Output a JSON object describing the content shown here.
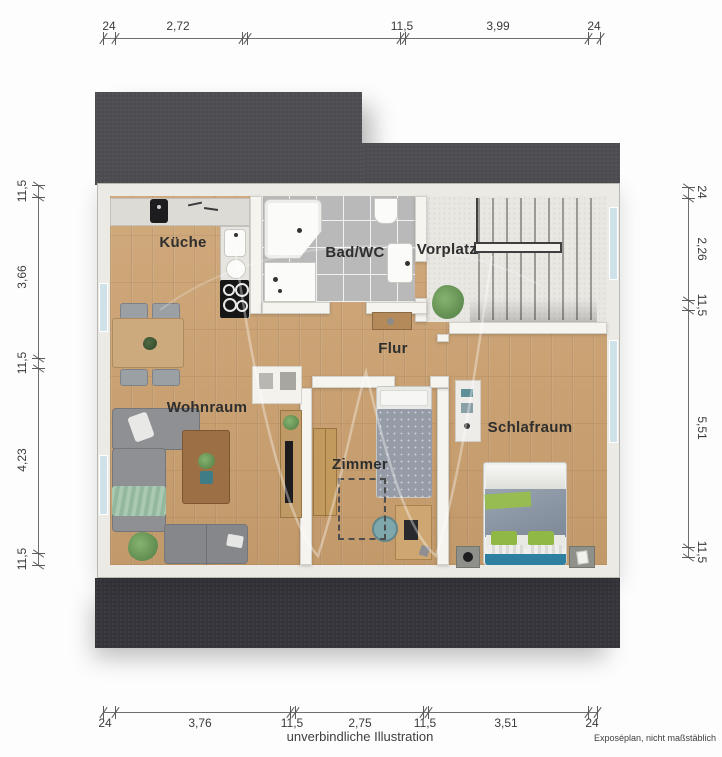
{
  "captions": {
    "center": "unverbindliche Illustration",
    "right": "Exposéplan, nicht maßstäblich"
  },
  "rooms": {
    "kueche": "Küche",
    "bad": "Bad/WC",
    "vorplatz": "Vorplatz",
    "flur": "Flur",
    "wohnraum": "Wohnraum",
    "zimmer": "Zimmer",
    "schlafraum": "Schlafraum"
  },
  "dimensions": {
    "top": [
      "24",
      "2,72",
      "11,5",
      "3,99",
      "24"
    ],
    "bottom": [
      "24",
      "3,76",
      "11,5",
      "2,75",
      "11,5",
      "3,51",
      "24"
    ],
    "left": [
      "11,5",
      "3,66",
      "11,5",
      "4,23",
      "11,5"
    ],
    "right": [
      "24",
      "2,26",
      "11,5",
      "5,51",
      "11,5"
    ]
  },
  "palette": {
    "roof_top": "#4c4c51",
    "roof_bottom": "#35353b",
    "wall": "#f5f4ef",
    "wood_floor": "#c9a172",
    "bath_tile": "#b9b9b9",
    "stone_floor": "#e8e7e2",
    "window": "#cfe2e9",
    "bed_headboard_blue": "#2e7fa0",
    "bed_pillow_green": "#8fb944",
    "sofa_gray": "#8e9094",
    "dimension_text": "#3a3a3a"
  }
}
